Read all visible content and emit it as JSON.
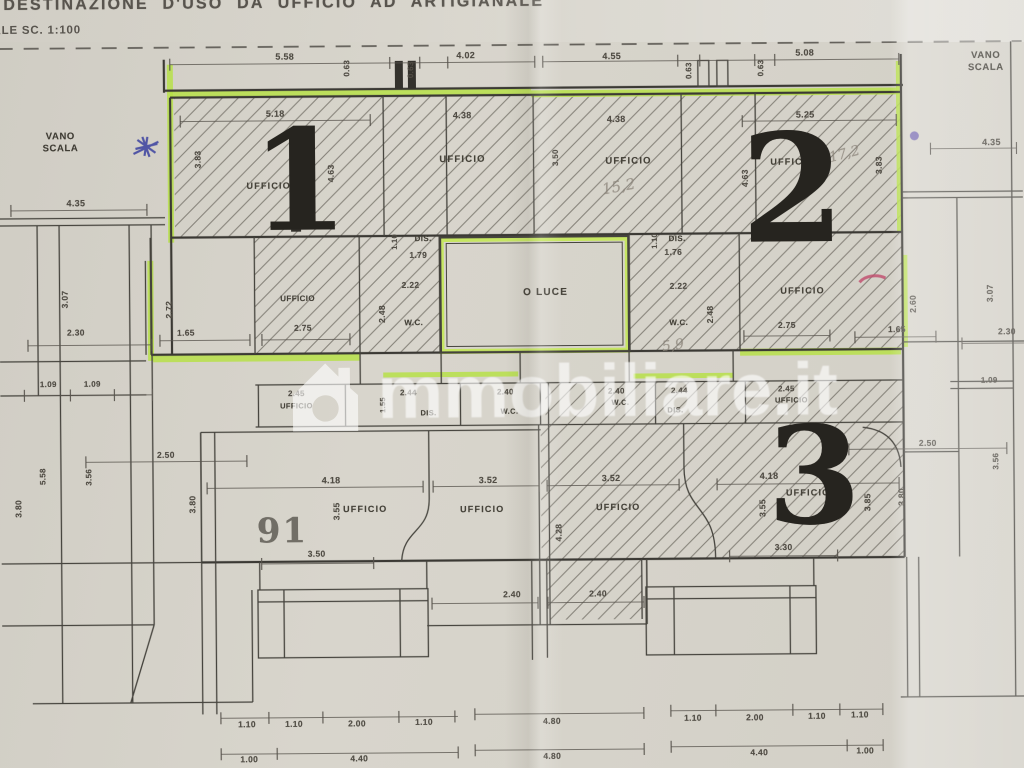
{
  "title": {
    "line1": "DESTINAZIONE D'USO DA UFFICIO AD ARTIGIANALE",
    "line2": "ALE SC. 1:100"
  },
  "watermark": {
    "icon": "house-icon",
    "text": "mmobiliare.it"
  },
  "colors": {
    "paper": "#d6d3ca",
    "highlighter_green": "#b7e049",
    "wall_ink": "#3f3d38",
    "pen_blue": "#3a3f9f",
    "pen_purple": "#6152a8",
    "pen_red": "#c04a6c",
    "pencil_gray": "#8f887d"
  },
  "units": {
    "unit1": "1",
    "unit2": "2",
    "unit3": "3",
    "parcel": "91"
  },
  "labels": [
    {
      "t": "5.58",
      "x": 287,
      "y": 55,
      "r": 0,
      "s": 9,
      "k": "dim"
    },
    {
      "t": "0.63",
      "x": 349,
      "y": 67,
      "r": -90,
      "s": 8,
      "k": "dim"
    },
    {
      "t": "0.63",
      "x": 413,
      "y": 69,
      "r": -90,
      "s": 8,
      "k": "dim"
    },
    {
      "t": "4.02",
      "x": 468,
      "y": 55,
      "r": 0,
      "s": 9,
      "k": "dim"
    },
    {
      "t": "4.55",
      "x": 614,
      "y": 57,
      "r": 0,
      "s": 9,
      "k": "dim"
    },
    {
      "t": "0.63",
      "x": 691,
      "y": 72,
      "r": -90,
      "s": 8,
      "k": "dim"
    },
    {
      "t": "0.63",
      "x": 763,
      "y": 70,
      "r": -90,
      "s": 8,
      "k": "dim"
    },
    {
      "t": "5.08",
      "x": 807,
      "y": 55,
      "r": 0,
      "s": 9,
      "k": "dim"
    },
    {
      "t": "VANO\nSCALA",
      "x": 62,
      "y": 140,
      "r": 0,
      "s": 9.5,
      "k": "note"
    },
    {
      "t": "4.35",
      "x": 77,
      "y": 200,
      "r": 0,
      "s": 9,
      "k": "dim"
    },
    {
      "t": "VANO\nSCALA",
      "x": 988,
      "y": 66,
      "r": 0,
      "s": 9.5,
      "k": "note"
    },
    {
      "t": "4.35",
      "x": 993,
      "y": 146,
      "r": 0,
      "s": 9,
      "k": "dim"
    },
    {
      "t": "5.18",
      "x": 277,
      "y": 112,
      "r": 0,
      "s": 9,
      "k": "dim"
    },
    {
      "t": "3.83",
      "x": 200,
      "y": 157,
      "r": -90,
      "s": 8.5,
      "k": "dim"
    },
    {
      "t": "UFFICIO",
      "x": 270,
      "y": 184,
      "r": 0,
      "s": 9,
      "k": "room"
    },
    {
      "t": "4.63",
      "x": 333,
      "y": 172,
      "r": -90,
      "s": 8.5,
      "k": "dim"
    },
    {
      "t": "4.38",
      "x": 464,
      "y": 115,
      "r": 0,
      "s": 9,
      "k": "dim"
    },
    {
      "t": "UFFICIO",
      "x": 464,
      "y": 160,
      "r": 0,
      "s": 9.5,
      "k": "room"
    },
    {
      "t": "3.50",
      "x": 557,
      "y": 158,
      "r": -90,
      "s": 8,
      "k": "dim"
    },
    {
      "t": "4.38",
      "x": 618,
      "y": 120,
      "r": 0,
      "s": 9,
      "k": "dim"
    },
    {
      "t": "UFFICIO",
      "x": 630,
      "y": 163,
      "r": 0,
      "s": 9.5,
      "k": "room"
    },
    {
      "t": "5.25",
      "x": 807,
      "y": 117,
      "r": 0,
      "s": 9,
      "k": "dim"
    },
    {
      "t": "UFFICIO",
      "x": 794,
      "y": 164,
      "r": 0,
      "s": 9,
      "k": "room"
    },
    {
      "t": "4.63",
      "x": 747,
      "y": 180,
      "r": -90,
      "s": 8.5,
      "k": "dim"
    },
    {
      "t": "3.83",
      "x": 881,
      "y": 168,
      "r": -90,
      "s": 8.5,
      "k": "dim"
    },
    {
      "t": "1",
      "x": 301,
      "y": 180,
      "r": 0,
      "s": 140,
      "k": "big"
    },
    {
      "t": "2",
      "x": 794,
      "y": 192,
      "r": 0,
      "s": 150,
      "k": "big"
    },
    {
      "t": "15,2",
      "x": 620,
      "y": 188,
      "r": -10,
      "s": 15,
      "k": "pencil"
    },
    {
      "t": "17,2",
      "x": 846,
      "y": 157,
      "r": -14,
      "s": 14,
      "k": "pencil"
    },
    {
      "t": "2.72",
      "x": 170,
      "y": 307,
      "r": -90,
      "s": 8.5,
      "k": "dim"
    },
    {
      "t": "1.65",
      "x": 186,
      "y": 331,
      "r": 0,
      "s": 8.5,
      "k": "dim"
    },
    {
      "t": "UFFICIO",
      "x": 298,
      "y": 297,
      "r": 0,
      "s": 8,
      "k": "room-sm"
    },
    {
      "t": "2.75",
      "x": 303,
      "y": 327,
      "r": 0,
      "s": 8.5,
      "k": "dim"
    },
    {
      "t": "1.10",
      "x": 396,
      "y": 241,
      "r": -90,
      "s": 7.5,
      "k": "dim"
    },
    {
      "t": "DIS.",
      "x": 424,
      "y": 238,
      "r": 0,
      "s": 8,
      "k": "room-sm"
    },
    {
      "t": "1.79",
      "x": 419,
      "y": 255,
      "r": 0,
      "s": 8.5,
      "k": "dim"
    },
    {
      "t": "2.22",
      "x": 411,
      "y": 285,
      "r": 0,
      "s": 8.5,
      "k": "dim"
    },
    {
      "t": "2.48",
      "x": 383,
      "y": 313,
      "r": -90,
      "s": 8.5,
      "k": "dim"
    },
    {
      "t": "W.C.",
      "x": 414,
      "y": 322,
      "r": 0,
      "s": 8,
      "k": "room-sm"
    },
    {
      "t": "O LUCE",
      "x": 546,
      "y": 293,
      "r": 0,
      "s": 10,
      "k": "room"
    },
    {
      "t": "1.10",
      "x": 656,
      "y": 242,
      "r": -90,
      "s": 7.5,
      "k": "dim"
    },
    {
      "t": "DIS.",
      "x": 678,
      "y": 240,
      "r": 0,
      "s": 8,
      "k": "room-sm"
    },
    {
      "t": "1.76",
      "x": 674,
      "y": 254,
      "r": 0,
      "s": 8.5,
      "k": "dim"
    },
    {
      "t": "2.22",
      "x": 679,
      "y": 288,
      "r": 0,
      "s": 8.5,
      "k": "dim"
    },
    {
      "t": "W.C.",
      "x": 679,
      "y": 324,
      "r": 0,
      "s": 8,
      "k": "room-sm"
    },
    {
      "t": "2.48",
      "x": 711,
      "y": 316,
      "r": -90,
      "s": 8.5,
      "k": "dim"
    },
    {
      "t": "5,9",
      "x": 673,
      "y": 347,
      "r": -8,
      "s": 14,
      "k": "pencil"
    },
    {
      "t": "UFFICIO",
      "x": 803,
      "y": 293,
      "r": 0,
      "s": 9,
      "k": "room"
    },
    {
      "t": "2.75",
      "x": 787,
      "y": 328,
      "r": 0,
      "s": 8.5,
      "k": "dim"
    },
    {
      "t": "1.65",
      "x": 897,
      "y": 333,
      "r": 0,
      "s": 8.5,
      "k": "dim"
    },
    {
      "t": "2.60",
      "x": 914,
      "y": 307,
      "r": -90,
      "s": 8.5,
      "k": "dim"
    },
    {
      "t": "3.07",
      "x": 66,
      "y": 296,
      "r": -90,
      "s": 8.5,
      "k": "dim"
    },
    {
      "t": "2.30",
      "x": 76,
      "y": 330,
      "r": 0,
      "s": 8.5,
      "k": "dim"
    },
    {
      "t": "1.09",
      "x": 48,
      "y": 381,
      "r": 0,
      "s": 8,
      "k": "dim"
    },
    {
      "t": "1.09",
      "x": 92,
      "y": 381,
      "r": 0,
      "s": 8,
      "k": "dim"
    },
    {
      "t": "3.07",
      "x": 991,
      "y": 297,
      "r": -90,
      "s": 8.5,
      "k": "dim"
    },
    {
      "t": "2.30",
      "x": 1007,
      "y": 336,
      "r": 0,
      "s": 8.5,
      "k": "dim"
    },
    {
      "t": "1.09",
      "x": 989,
      "y": 384,
      "r": 0,
      "s": 8,
      "k": "dim"
    },
    {
      "t": "2.45",
      "x": 296,
      "y": 392,
      "r": 0,
      "s": 8,
      "k": "dim"
    },
    {
      "t": "UFFICIO",
      "x": 296,
      "y": 405,
      "r": 0,
      "s": 7.5,
      "k": "room-sm"
    },
    {
      "t": "1.55",
      "x": 383,
      "y": 404,
      "r": -90,
      "s": 7.5,
      "k": "dim"
    },
    {
      "t": "2.44",
      "x": 408,
      "y": 392,
      "r": 0,
      "s": 8,
      "k": "dim"
    },
    {
      "t": "DIS.",
      "x": 428,
      "y": 413,
      "r": 0,
      "s": 7.5,
      "k": "room-sm"
    },
    {
      "t": "2.40",
      "x": 505,
      "y": 392,
      "r": 0,
      "s": 8,
      "k": "dim"
    },
    {
      "t": "W.C.",
      "x": 509,
      "y": 412,
      "r": 0,
      "s": 7.5,
      "k": "room-sm"
    },
    {
      "t": "2.40",
      "x": 616,
      "y": 392,
      "r": 0,
      "s": 8,
      "k": "dim"
    },
    {
      "t": "W.C.",
      "x": 620,
      "y": 404,
      "r": 0,
      "s": 7.5,
      "k": "room-sm"
    },
    {
      "t": "2.44",
      "x": 679,
      "y": 392,
      "r": 0,
      "s": 8,
      "k": "dim"
    },
    {
      "t": "DIS.",
      "x": 675,
      "y": 412,
      "r": 0,
      "s": 7.5,
      "k": "room-sm"
    },
    {
      "t": "2.45",
      "x": 786,
      "y": 391,
      "r": 0,
      "s": 8,
      "k": "dim"
    },
    {
      "t": "UFFICIO",
      "x": 791,
      "y": 403,
      "r": 0,
      "s": 7.5,
      "k": "room-sm"
    },
    {
      "t": "91",
      "x": 281,
      "y": 530,
      "r": 0,
      "s": 34,
      "k": "gray"
    },
    {
      "t": "4.18",
      "x": 330,
      "y": 479,
      "r": 0,
      "s": 9,
      "k": "dim"
    },
    {
      "t": "3.55",
      "x": 336,
      "y": 510,
      "r": -90,
      "s": 8.5,
      "k": "dim"
    },
    {
      "t": "UFFICIO",
      "x": 364,
      "y": 508,
      "r": 0,
      "s": 9,
      "k": "room"
    },
    {
      "t": "3.50",
      "x": 315,
      "y": 553,
      "r": 0,
      "s": 8.5,
      "k": "dim"
    },
    {
      "t": "3.52",
      "x": 487,
      "y": 480,
      "r": 0,
      "s": 9,
      "k": "dim"
    },
    {
      "t": "UFFICIO",
      "x": 481,
      "y": 509,
      "r": 0,
      "s": 9,
      "k": "room"
    },
    {
      "t": "3.52",
      "x": 610,
      "y": 479,
      "r": 0,
      "s": 9,
      "k": "dim"
    },
    {
      "t": "UFFICIO",
      "x": 617,
      "y": 508,
      "r": 0,
      "s": 9,
      "k": "room"
    },
    {
      "t": "4.28",
      "x": 558,
      "y": 533,
      "r": -90,
      "s": 8.5,
      "k": "dim"
    },
    {
      "t": "4.18",
      "x": 768,
      "y": 478,
      "r": 0,
      "s": 9,
      "k": "dim"
    },
    {
      "t": "3.55",
      "x": 762,
      "y": 510,
      "r": -90,
      "s": 8.5,
      "k": "dim"
    },
    {
      "t": "UFFICIO",
      "x": 807,
      "y": 495,
      "r": 0,
      "s": 9,
      "k": "room"
    },
    {
      "t": "3.30",
      "x": 782,
      "y": 550,
      "r": 0,
      "s": 8.5,
      "k": "dim"
    },
    {
      "t": "3.85",
      "x": 867,
      "y": 505,
      "r": -90,
      "s": 8.5,
      "k": "dim"
    },
    {
      "t": "3",
      "x": 813,
      "y": 478,
      "r": 0,
      "s": 135,
      "k": "big"
    },
    {
      "t": "2.40",
      "x": 510,
      "y": 595,
      "r": 0,
      "s": 8.5,
      "k": "dim"
    },
    {
      "t": "2.40",
      "x": 596,
      "y": 595,
      "r": 0,
      "s": 8.5,
      "k": "dim"
    },
    {
      "t": "2.50",
      "x": 165,
      "y": 453,
      "r": 0,
      "s": 8.5,
      "k": "dim"
    },
    {
      "t": "5.58",
      "x": 42,
      "y": 473,
      "r": -90,
      "s": 8,
      "k": "dim"
    },
    {
      "t": "3.56",
      "x": 88,
      "y": 474,
      "r": -90,
      "s": 8,
      "k": "dim"
    },
    {
      "t": "3.80",
      "x": 18,
      "y": 505,
      "r": -90,
      "s": 8.5,
      "k": "dim"
    },
    {
      "t": "3.80",
      "x": 192,
      "y": 502,
      "r": -90,
      "s": 8.5,
      "k": "dim"
    },
    {
      "t": "2.50",
      "x": 927,
      "y": 447,
      "r": 0,
      "s": 8.5,
      "k": "dim"
    },
    {
      "t": "3.56",
      "x": 995,
      "y": 465,
      "r": -90,
      "s": 8,
      "k": "dim"
    },
    {
      "t": "3.80",
      "x": 901,
      "y": 500,
      "r": -90,
      "s": 8.5,
      "k": "dim"
    },
    {
      "t": "1.10",
      "x": 244,
      "y": 723,
      "r": 0,
      "s": 8.5,
      "k": "dim"
    },
    {
      "t": "1.10",
      "x": 291,
      "y": 723,
      "r": 0,
      "s": 8.5,
      "k": "dim"
    },
    {
      "t": "2.00",
      "x": 354,
      "y": 723,
      "r": 0,
      "s": 8.5,
      "k": "dim"
    },
    {
      "t": "1.10",
      "x": 421,
      "y": 722,
      "r": 0,
      "s": 8.5,
      "k": "dim"
    },
    {
      "t": "4.80",
      "x": 549,
      "y": 722,
      "r": 0,
      "s": 8.5,
      "k": "dim"
    },
    {
      "t": "1.10",
      "x": 690,
      "y": 720,
      "r": 0,
      "s": 8.5,
      "k": "dim"
    },
    {
      "t": "2.00",
      "x": 752,
      "y": 720,
      "r": 0,
      "s": 8.5,
      "k": "dim"
    },
    {
      "t": "1.10",
      "x": 814,
      "y": 719,
      "r": 0,
      "s": 8.5,
      "k": "dim"
    },
    {
      "t": "1.10",
      "x": 857,
      "y": 718,
      "r": 0,
      "s": 8.5,
      "k": "dim"
    },
    {
      "t": "1.00",
      "x": 246,
      "y": 758,
      "r": 0,
      "s": 8.5,
      "k": "dim"
    },
    {
      "t": "4.40",
      "x": 356,
      "y": 758,
      "r": 0,
      "s": 8.5,
      "k": "dim"
    },
    {
      "t": "4.80",
      "x": 549,
      "y": 757,
      "r": 0,
      "s": 8.5,
      "k": "dim"
    },
    {
      "t": "4.40",
      "x": 756,
      "y": 755,
      "r": 0,
      "s": 8.5,
      "k": "dim"
    },
    {
      "t": "1.00",
      "x": 862,
      "y": 754,
      "r": 0,
      "s": 8.5,
      "k": "dim"
    }
  ]
}
